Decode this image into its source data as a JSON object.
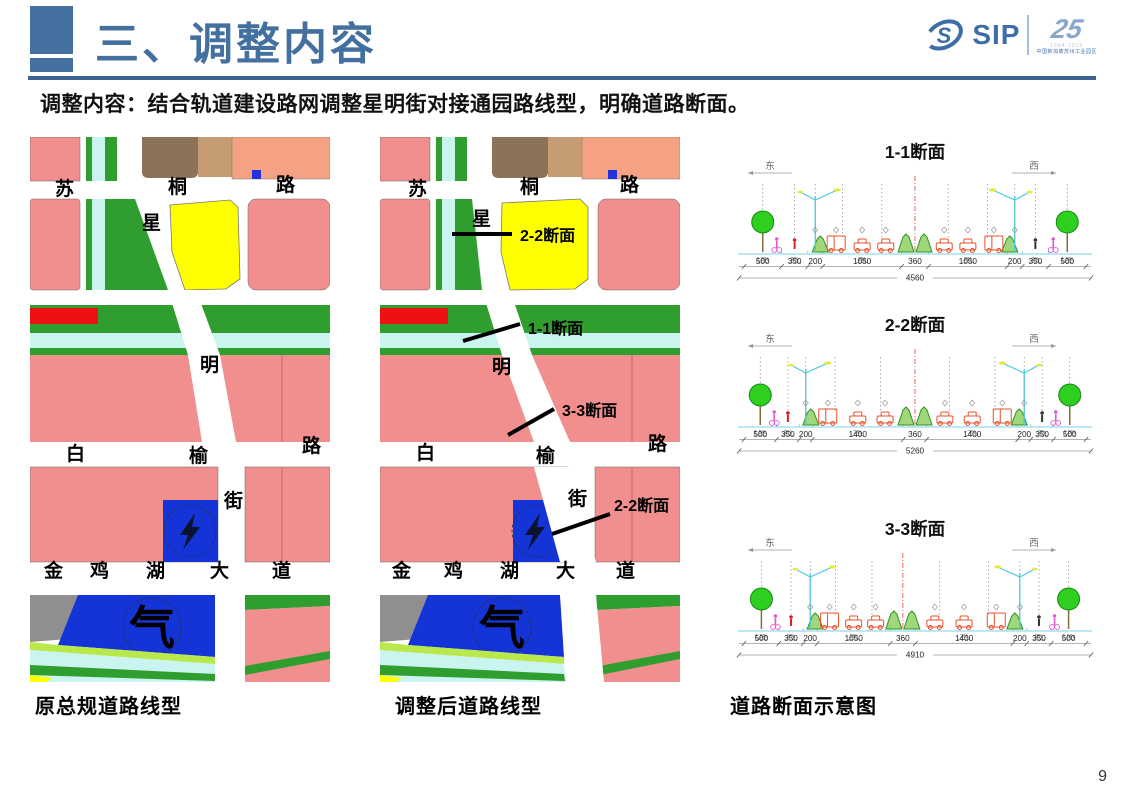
{
  "slide": {
    "title": "三、调整内容",
    "intro": "调整内容：结合轨道建设路网调整星明街对接通园路线型，明确道路断面。",
    "page_number": "9"
  },
  "logo": {
    "brand": "SIP",
    "anniversary": "25",
    "years": "1994-2019",
    "tagline": "中国新加坡苏州工业园区"
  },
  "colors": {
    "accent_blue": "#44709f",
    "parcel_pink": "#f18f8f",
    "parcel_salmon": "#f5a183",
    "parcel_brown": "#8c7357",
    "parcel_tan": "#c69c74",
    "parcel_yellow": "#ffff00",
    "green": "#2f9e2f",
    "stream_cyan": "#c9f4ef",
    "parcel_red": "#ee1111",
    "parcel_blue": "#1534d8",
    "parcel_gray": "#8f8f8f"
  },
  "maps": {
    "road_labels": {
      "su": "苏",
      "tong": "桐",
      "lu": "路",
      "xing": "星",
      "ming": "明",
      "jie": "街",
      "bai": "白",
      "yu": "榆",
      "lu2": "路",
      "jin": "金",
      "ji": "鸡",
      "hu": "湖",
      "da": "大",
      "dao": "道",
      "gas": "气"
    },
    "original": {
      "caption": "原总规道路线型"
    },
    "adjusted": {
      "caption": "调整后道路线型",
      "annotations": {
        "top": "2-2断面",
        "mid1": "1-1断面",
        "mid2": "3-3断面",
        "bottom": "2-2断面"
      }
    }
  },
  "sections_panel": {
    "caption": "道路断面示意图",
    "east_label": "东",
    "west_label": "西",
    "sections": [
      {
        "title": "1-1断面",
        "dims": [
          500,
          350,
          200,
          1050,
          360,
          1050,
          200,
          350,
          500
        ],
        "total": "4560",
        "slopes": [
          "1.5%",
          "2%",
          "2%",
          "2%",
          "2%",
          "1.5%"
        ]
      },
      {
        "title": "2-2断面",
        "dims": [
          500,
          350,
          200,
          1400,
          360,
          1400,
          200,
          350,
          500
        ],
        "total": "5260",
        "slopes": [
          "1.5%",
          "2%",
          "2%",
          "2%",
          "2%",
          "1.5%"
        ]
      },
      {
        "title": "3-3断面",
        "dims": [
          500,
          350,
          200,
          1050,
          360,
          1400,
          200,
          350,
          500
        ],
        "total": "4910",
        "slopes": [
          "1.5%",
          "2%",
          "2%",
          "2%",
          "2%",
          "1.5%"
        ]
      }
    ]
  }
}
